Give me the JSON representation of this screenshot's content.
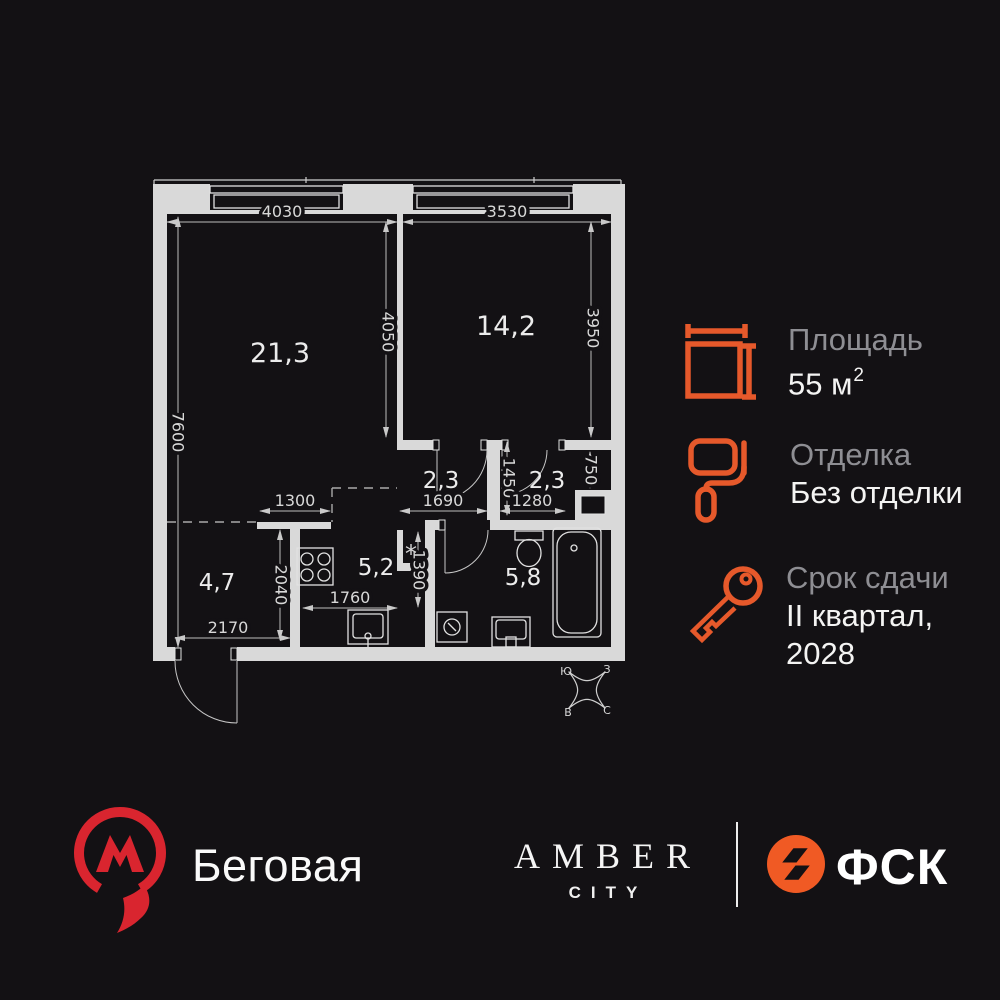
{
  "colors": {
    "background": "#131114",
    "accent_orange": "#E6592B",
    "metro_red": "#D9252F",
    "fsk_orange": "#F05A24",
    "plan_wall_gray": "#D9D9D9"
  },
  "plan": {
    "rooms": [
      {
        "name": "living-room",
        "area": "21,3"
      },
      {
        "name": "bedroom",
        "area": "14,2"
      },
      {
        "name": "hallway",
        "area": "2,3"
      },
      {
        "name": "hallway-2",
        "area": "2,3"
      },
      {
        "name": "wardrobe-zone",
        "area": "4,7"
      },
      {
        "name": "kitchen",
        "area": "5,2"
      },
      {
        "name": "bathroom",
        "area": "5,8"
      }
    ],
    "dims": {
      "living_width": "4030",
      "bedroom_width": "3530",
      "left_height": "7600",
      "mid_height": "4050",
      "bedroom_height": "3950",
      "shaft_height": "750",
      "hall_height": "1450",
      "hall_width": "1690",
      "hall2_width": "1280",
      "wardrobe_top_width": "1300",
      "kitchen_height": "2040",
      "niche_height": "1390",
      "kitchen_width": "1760",
      "wardrobe_width": "2170"
    },
    "compass": {
      "top_left": "Ю",
      "top_right": "З",
      "bottom_left": "В",
      "bottom_right": "С"
    },
    "washer_marker": "*"
  },
  "info": {
    "items": [
      {
        "label": "Площадь",
        "value": "55 м",
        "sup": "2"
      },
      {
        "label": "Отделка",
        "value": "Без отделки"
      },
      {
        "label": "Срок сдачи",
        "value_line1": "II квартал,",
        "value_line2": "2028"
      }
    ]
  },
  "footer": {
    "station": "Беговая",
    "brand_top": "AMBER",
    "brand_sub": "CITY",
    "developer": "ФСК"
  }
}
